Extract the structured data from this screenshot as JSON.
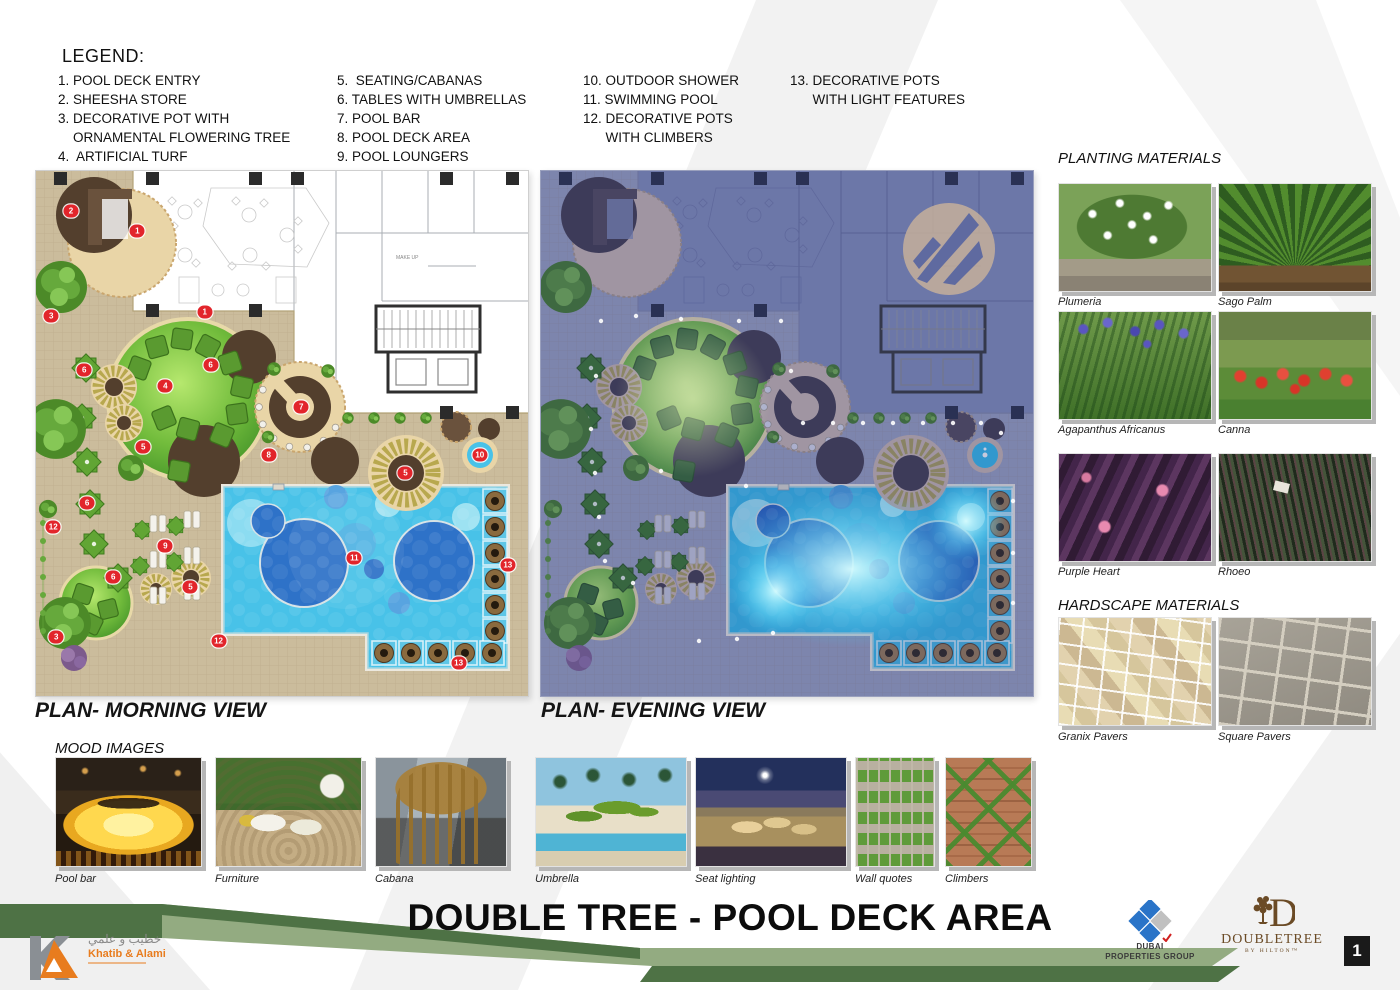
{
  "legend": {
    "title": "LEGEND:",
    "col1": "1. POOL DECK ENTRY\n2. SHEESHA STORE\n3. DECORATIVE POT WITH\n    ORNAMENTAL FLOWERING TREE\n4.  ARTIFICIAL TURF",
    "col2": "5.  SEATING/CABANAS\n6. TABLES WITH UMBRELLAS\n7. POOL BAR\n8. POOL DECK AREA\n9. POOL LOUNGERS",
    "col3": "10. OUTDOOR SHOWER\n11. SWIMMING POOL\n12. DECORATIVE POTS\n      WITH CLIMBERS",
    "col4": "13. DECORATIVE POTS\n      WITH LIGHT FEATURES"
  },
  "plans": {
    "morning_label": "PLAN- MORNING VIEW",
    "evening_label": "PLAN- EVENING VIEW",
    "interior_text": "MAKE UP",
    "markers": [
      {
        "n": "2",
        "x": 7.1,
        "y": 7.6
      },
      {
        "n": "1",
        "x": 20.6,
        "y": 11.5
      },
      {
        "n": "1",
        "x": 34.3,
        "y": 26.8
      },
      {
        "n": "3",
        "x": 3.1,
        "y": 27.7
      },
      {
        "n": "6",
        "x": 9.8,
        "y": 37.9
      },
      {
        "n": "6",
        "x": 35.5,
        "y": 36.9
      },
      {
        "n": "4",
        "x": 26.3,
        "y": 40.9
      },
      {
        "n": "7",
        "x": 53.9,
        "y": 44.9
      },
      {
        "n": "8",
        "x": 47.3,
        "y": 54.1
      },
      {
        "n": "5",
        "x": 21.8,
        "y": 52.6
      },
      {
        "n": "5",
        "x": 75.1,
        "y": 57.6
      },
      {
        "n": "10",
        "x": 90.2,
        "y": 54.1
      },
      {
        "n": "6",
        "x": 10.4,
        "y": 63.3
      },
      {
        "n": "12",
        "x": 3.5,
        "y": 67.9
      },
      {
        "n": "9",
        "x": 26.3,
        "y": 71.5
      },
      {
        "n": "11",
        "x": 64.7,
        "y": 73.8
      },
      {
        "n": "13",
        "x": 95.9,
        "y": 75.1
      },
      {
        "n": "6",
        "x": 15.7,
        "y": 77.4
      },
      {
        "n": "5",
        "x": 31.4,
        "y": 79.2
      },
      {
        "n": "3",
        "x": 4.1,
        "y": 88.7
      },
      {
        "n": "12",
        "x": 37.1,
        "y": 89.5
      },
      {
        "n": "13",
        "x": 85.9,
        "y": 93.7
      }
    ]
  },
  "planting": {
    "title": "PLANTING MATERIALS",
    "items": [
      {
        "label": "Plumeria"
      },
      {
        "label": "Sago Palm"
      },
      {
        "label": "Agapanthus Africanus"
      },
      {
        "label": "Canna"
      },
      {
        "label": "Purple Heart"
      },
      {
        "label": "Rhoeo"
      }
    ]
  },
  "hardscape": {
    "title": "HARDSCAPE MATERIALS",
    "items": [
      {
        "label": "Granix Pavers"
      },
      {
        "label": "Square Pavers"
      }
    ]
  },
  "mood": {
    "title": "MOOD IMAGES",
    "items": [
      {
        "label": "Pool bar"
      },
      {
        "label": "Furniture"
      },
      {
        "label": "Cabana"
      },
      {
        "label": "Umbrella"
      },
      {
        "label": "Seat lighting"
      },
      {
        "label": "Wall quotes"
      },
      {
        "label": "Climbers"
      }
    ]
  },
  "footer": {
    "title": "DOUBLE TREE - POOL DECK AREA",
    "page_number": "1",
    "khatib": {
      "arabic": "خطيب و علمي",
      "name": "Khatib & Alami"
    },
    "dubai": {
      "line1": "DUBAI",
      "line2": "PROPERTIES GROUP"
    },
    "doubletree": {
      "name": "DOUBLETREE",
      "sub": "BY HILTON™"
    }
  },
  "colors": {
    "marker_red": "#e2252b",
    "ribbon_dark": "#4e7245",
    "ribbon_light": "#93ab81",
    "pool_blue": "#48c2e8",
    "deck_tan": "#cbbc9c",
    "lawn_green": "#62b234"
  }
}
